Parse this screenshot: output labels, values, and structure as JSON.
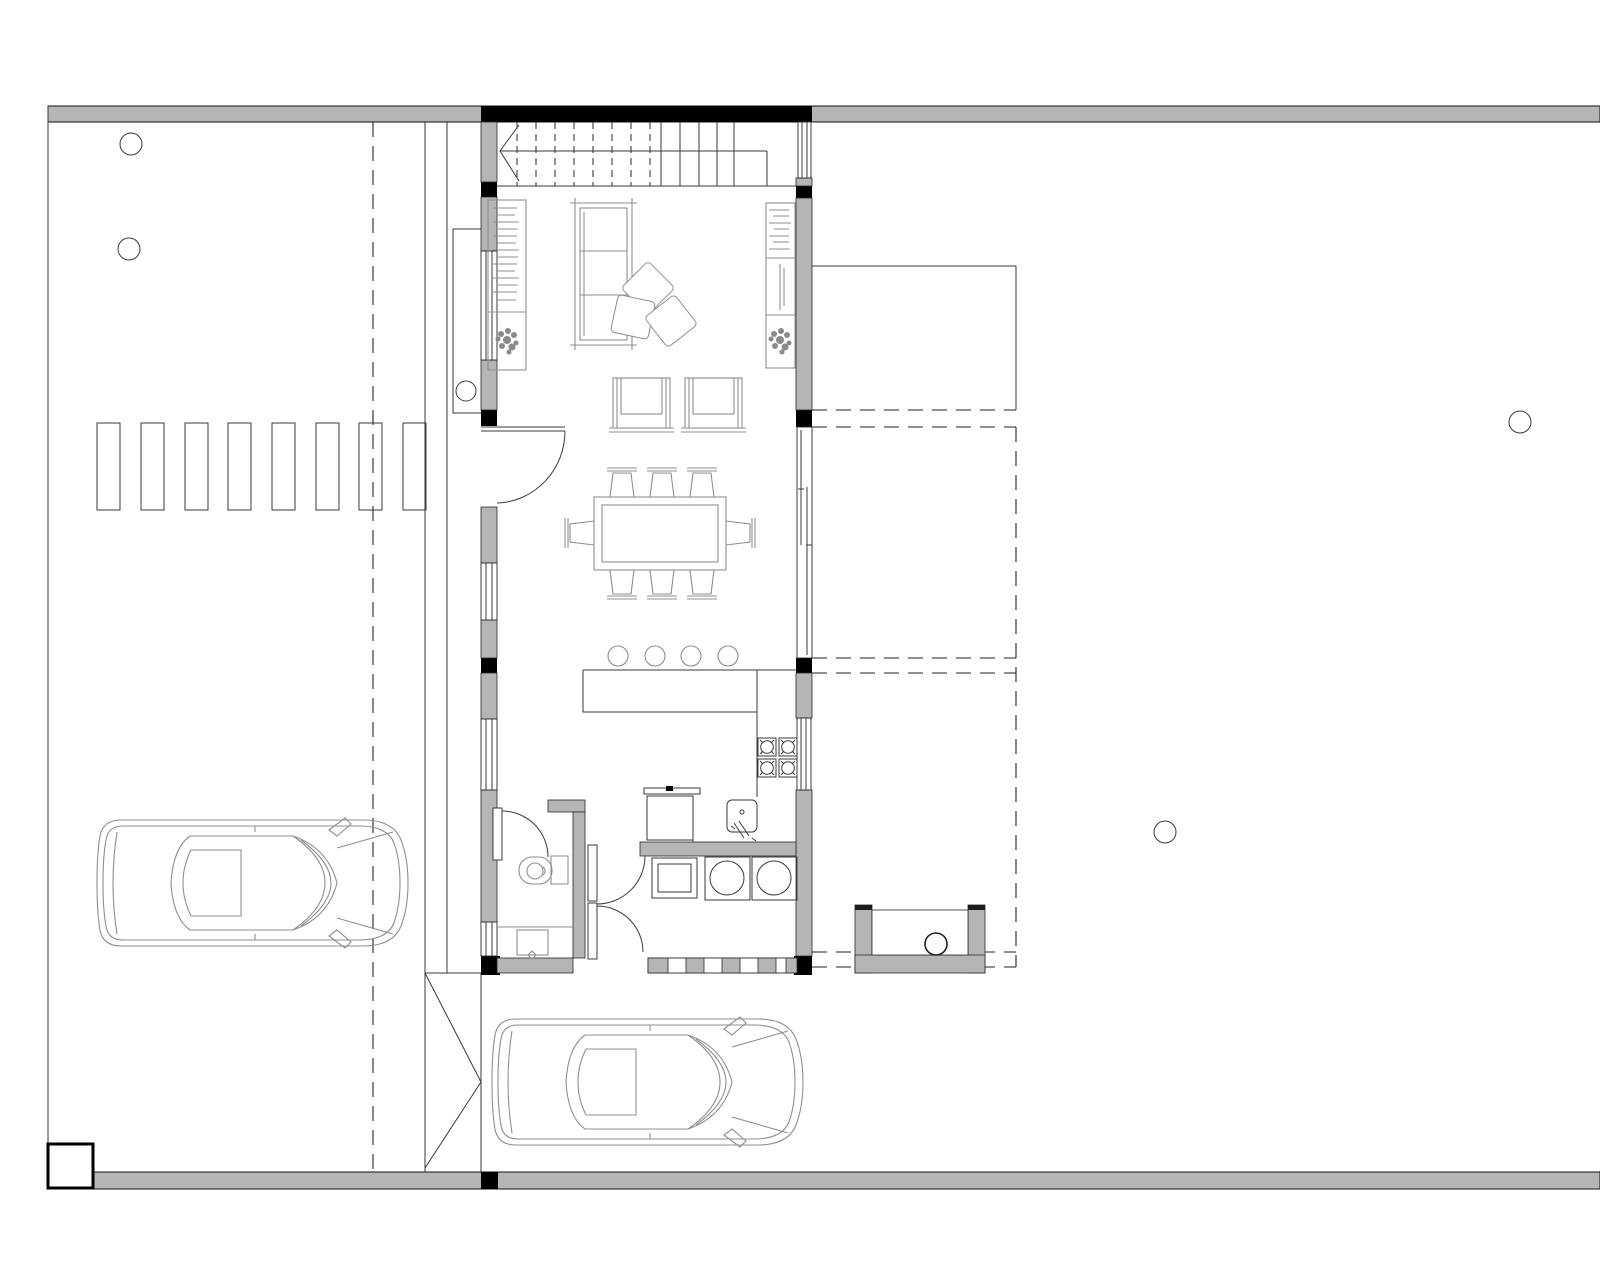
{
  "document": {
    "type": "architectural-floor-plan",
    "view": "top-down plan, ground floor with site"
  },
  "colors": {
    "background": "#ffffff",
    "wall_fill": "#b5b5b5",
    "structure_black": "#000000",
    "site_line": "#3a3a3a",
    "furniture_line": "#8f8f8f",
    "dashed_line": "#222222"
  },
  "site": {
    "boundary_bands": 2,
    "left_boundary_line": true,
    "corner_marker_box": true,
    "property_dashed_line": true,
    "driveway_edge_lines": 2,
    "parking_pavers": 8,
    "site_circles_trees": 4,
    "entry_gate_leaves": 2,
    "entry_porch_slab": 1,
    "porch_circle": 1,
    "cars": 2
  },
  "building": {
    "rooms": [
      "staircase",
      "living-area",
      "dining-area",
      "kitchen",
      "bathroom",
      "laundry-utility",
      "carport",
      "terrace"
    ],
    "stairs": {
      "dashed_risers": 8,
      "solid_risers": 5,
      "direction_arrow": true
    },
    "windows_left_wall": 4,
    "windows_right_wall": 3,
    "sliding_door_right_wall": 1,
    "entry_door": 1,
    "bathroom_door": 1,
    "double_swing_doors": 2,
    "terrace_outline": "solid + dashed overhang lines",
    "outdoor_planter_basin": 1
  },
  "furniture": {
    "sofa": {
      "count": 1,
      "seats": 3
    },
    "floor_cushions": 3,
    "lounge_chairs": 2,
    "bookshelf_units": 2,
    "plants_in_shelves": 2,
    "dining_table": 1,
    "dining_chairs": 8,
    "bar_stools": 4,
    "kitchen_counter": "L-shaped",
    "cooktop_burners": 4,
    "kitchen_sink": 1,
    "countertop_appliance": 1,
    "laundry_machines": 2,
    "laundry_cabinet": 1,
    "toilet": 1,
    "bathroom_sink": 1
  }
}
